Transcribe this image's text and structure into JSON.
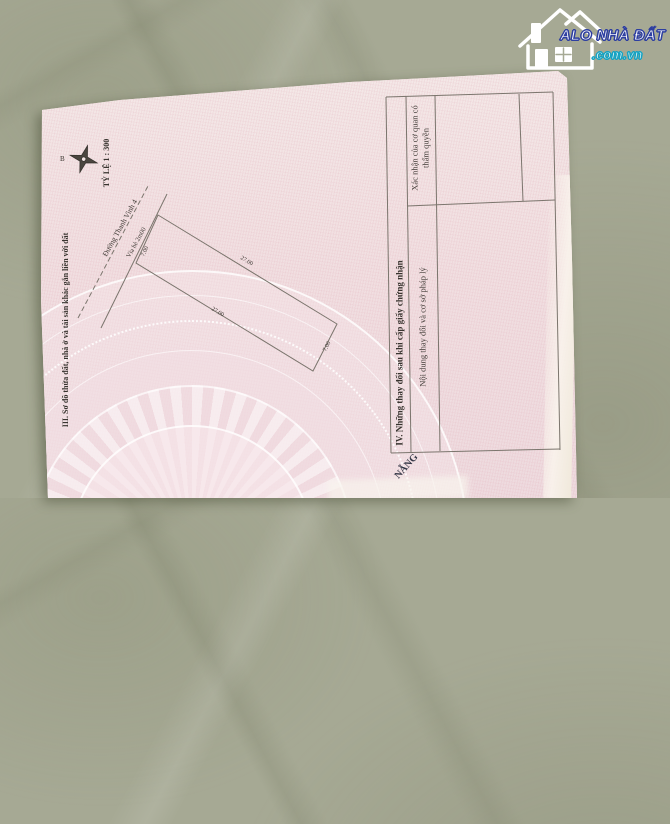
{
  "background": {
    "surface_color": "#a6a994"
  },
  "watermark": {
    "brand": "ALO NHÀ ĐẤT",
    "domain": ".com.vn",
    "brand_outline_color": "#2d3ea0",
    "domain_outline_color": "#13a3c4",
    "icon": "house-icon"
  },
  "certificate": {
    "paper_color": "#f2e5e4",
    "compass_label": "B",
    "scale_label": "TỶ LỆ 1 : 300",
    "section3_title": "III. Sơ đồ thửa đất, nhà ở và tài sản khác gắn liền với đất",
    "sketch": {
      "road_name": "Đường Thanh Vinh 4",
      "sidewalk_label": "Vỉa hè 2m00",
      "dims": {
        "front": "7.00",
        "back": "7.00",
        "side_top": "27.00",
        "side_bottom": "27.00"
      }
    },
    "section4_title": "IV. Những thay đổi sau khi cấp giấy chứng nhận",
    "table": {
      "col_content": "Nội dung thay đổi và cơ sở pháp lý",
      "col_confirm": "Xác nhận của cơ quan có thẩm quyền"
    },
    "partial_stamp_text": "NẴNG"
  }
}
